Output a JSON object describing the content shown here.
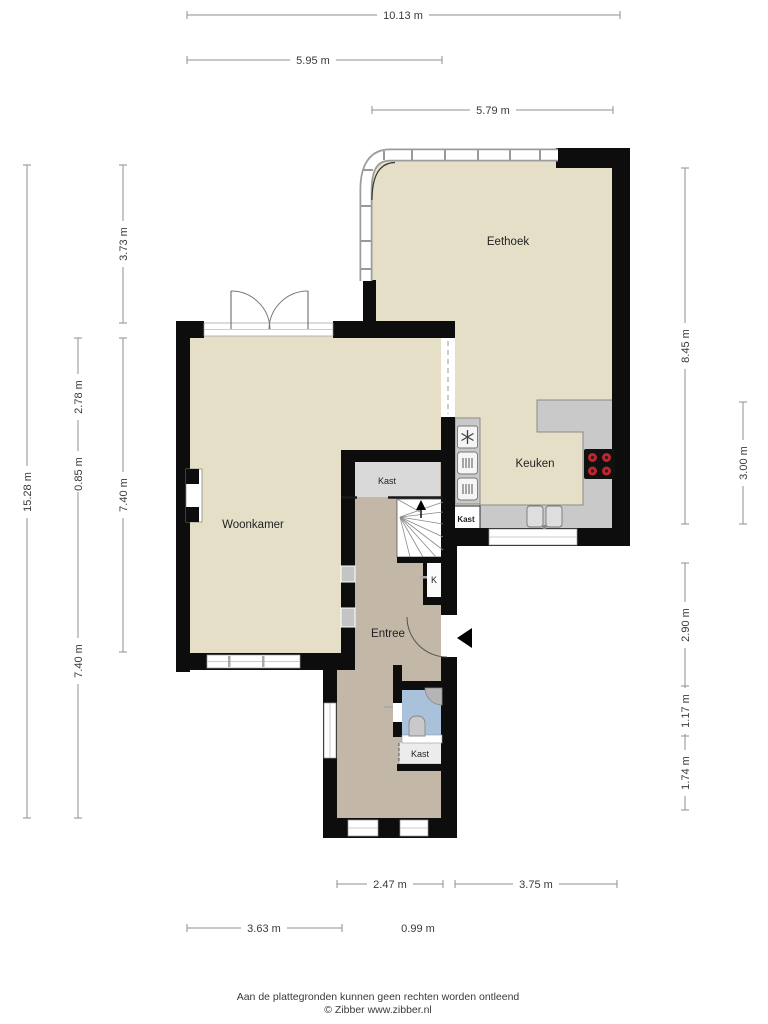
{
  "floorplan": {
    "rooms": {
      "eethoek": "Eethoek",
      "woonkamer": "Woonkamer",
      "keuken": "Keuken",
      "entree": "Entree",
      "kast_hal": "Kast",
      "kast_keuken": "Kast",
      "kast_onder": "Kast",
      "k_closet": "K"
    },
    "dimensions": {
      "top": [
        "10.13 m",
        "5.95 m",
        "5.79 m"
      ],
      "bottom": [
        "2.47 m",
        "3.75 m",
        "3.63 m",
        "0.99 m"
      ],
      "left": [
        "15.28 m",
        "2.78 m",
        "0.85 m",
        "7.40 m",
        "3.73 m",
        "7.40 m"
      ],
      "right": [
        "8.45 m",
        "3.00 m",
        "2.90 m",
        "1.17 m",
        "1.74 m"
      ]
    },
    "footer": {
      "disclaimer": "Aan de plattegronden kunnen geen rechten worden ontleend",
      "credit": "© Zibber www.zibber.nl"
    },
    "colors": {
      "wall": "#0d0d0d",
      "room_fill": "#e6dfc8",
      "hall_fill": "#c3b7a7",
      "closet_fill": "#d9d9d9",
      "counter_fill": "#c9c9c9",
      "toilet_fill": "#a9c1da",
      "burner_red": "#c0262c",
      "dimension_line": "#8f8f8f"
    }
  }
}
